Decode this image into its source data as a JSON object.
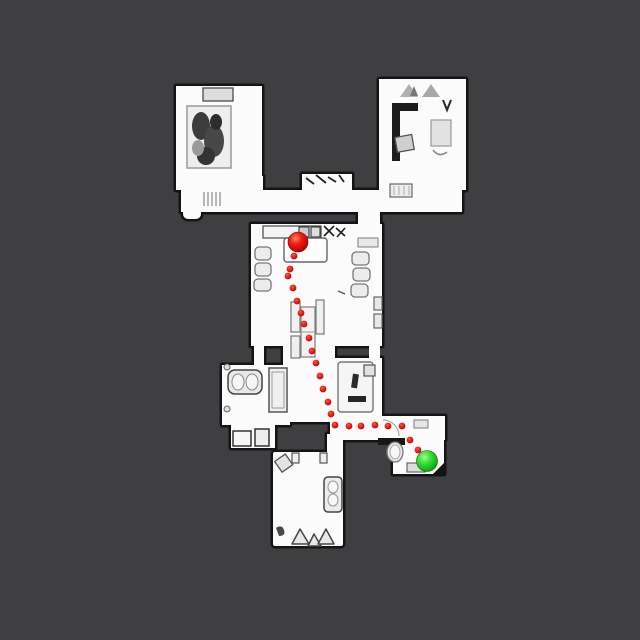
{
  "scene": {
    "kind": "top-down floorplan navigation map",
    "background_color": "#3f3f41",
    "floor_color": "#fbfbfb",
    "wall_color": "#141414"
  },
  "map": {
    "start_marker": {
      "label": "start",
      "x": 298,
      "y": 242,
      "r": 10,
      "color": "#d50f0f"
    },
    "goal_marker": {
      "label": "goal",
      "x": 427,
      "y": 461,
      "r": 10.5,
      "color": "#1fc11f"
    },
    "path_color": "#dd1111",
    "path_dot_radius": 3.4,
    "path_dots": [
      [
        294,
        256
      ],
      [
        290,
        269
      ],
      [
        288,
        276
      ],
      [
        293,
        288
      ],
      [
        297,
        301
      ],
      [
        301,
        313
      ],
      [
        304,
        324
      ],
      [
        309,
        338
      ],
      [
        312,
        351
      ],
      [
        316,
        363
      ],
      [
        320,
        376
      ],
      [
        323,
        389
      ],
      [
        328,
        402
      ],
      [
        331,
        414
      ],
      [
        335,
        425
      ],
      [
        349,
        426
      ],
      [
        361,
        426
      ],
      [
        375,
        425
      ],
      [
        388,
        426
      ],
      [
        402,
        426
      ],
      [
        410,
        440
      ],
      [
        418,
        450
      ]
    ]
  }
}
